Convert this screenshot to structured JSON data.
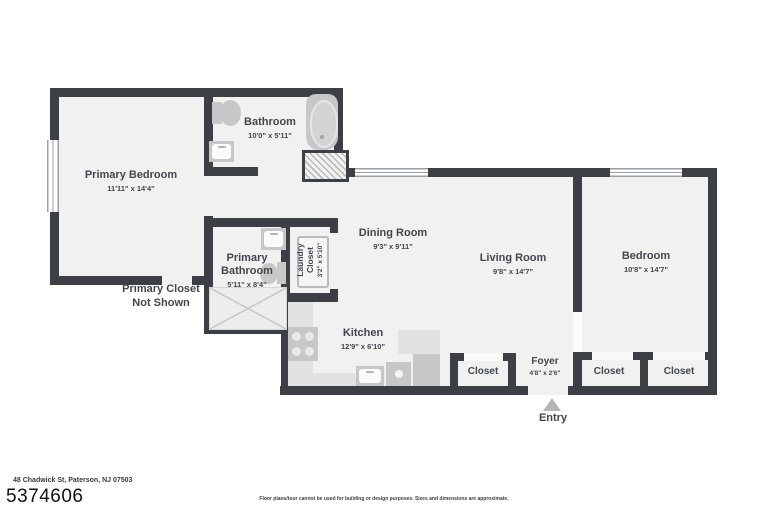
{
  "rooms": {
    "primary_bedroom": {
      "name": "Primary Bedroom",
      "dims": "11'11\" x 14'4\""
    },
    "bathroom": {
      "name": "Bathroom",
      "dims": "10'0\" x 5'11\""
    },
    "primary_bathroom": {
      "name": "Primary Bathroom",
      "dims": "5'11\" x 8'4\""
    },
    "laundry_closet": {
      "name": "Laundry Closet",
      "dims": "3'2\" x 5'10\""
    },
    "dining_room": {
      "name": "Dining Room",
      "dims": "9'3\" x 9'11\""
    },
    "living_room": {
      "name": "Living Room",
      "dims": "9'8\" x 14'7\""
    },
    "kitchen": {
      "name": "Kitchen",
      "dims": "12'9\" x 6'10\""
    },
    "bedroom": {
      "name": "Bedroom",
      "dims": "10'8\" x 14'7\""
    },
    "foyer": {
      "name": "Foyer",
      "dims": "4'8\" x 2'6\""
    }
  },
  "closets": {
    "living": "Closet",
    "bedroom_left": "Closet",
    "bedroom_right": "Closet"
  },
  "annotations": {
    "primary_closet_line1": "Primary Closet",
    "primary_closet_line2": "Not Shown",
    "entry": "Entry"
  },
  "footer": {
    "address": "48 Chadwick St, Paterson, NJ 07503",
    "listing_id": "5374606",
    "disclaimer": "Floor plans/tour cannot be used for building or design purposes. Sizes and dimensions are approximate."
  },
  "colors": {
    "wall": "#3c4045",
    "floor": "#f1f1f2",
    "fixture": "#c6c7c9",
    "counter": "#e1e2e3",
    "arrow": "#b5b7b9",
    "text": "#42474d"
  }
}
